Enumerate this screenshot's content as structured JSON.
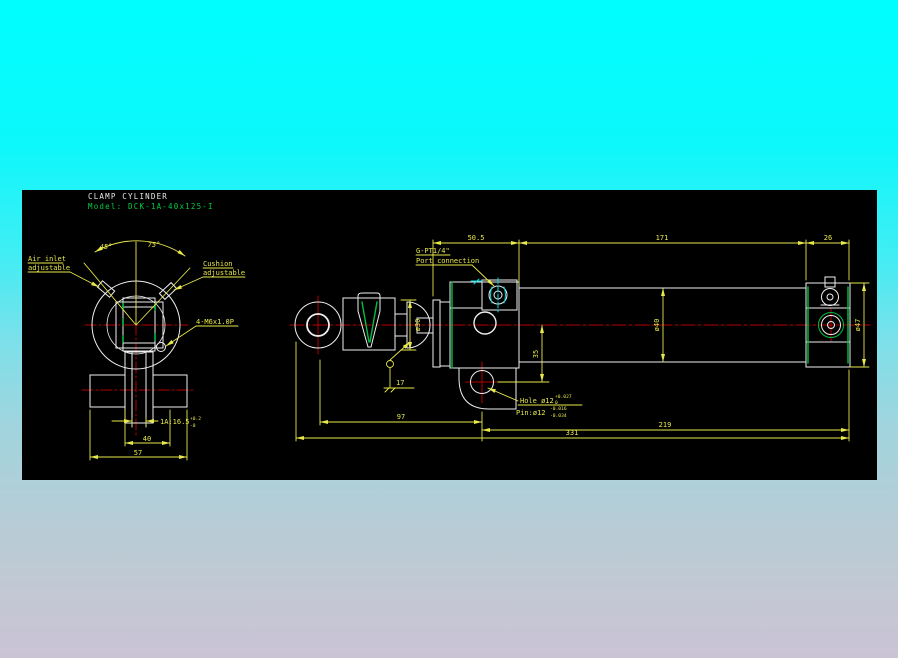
{
  "title_block": {
    "title": "CLAMP CYLINDER",
    "model": "Model: DCK-1A-40x125-I"
  },
  "colors": {
    "annotation_yellow": "#e8e84a",
    "outline_white": "#efefef",
    "centerline_red": "#b40000",
    "highlight_green": "#00c040",
    "highlight_cyan": "#00dede",
    "model_green": "#00cc44",
    "canvas_black": "#000000"
  },
  "front_view": {
    "labels": {
      "air_inlet": [
        "Air inlet",
        "adjustable"
      ],
      "cushion": [
        "Cushion",
        "adjustable"
      ],
      "thread": "4-M6x1.0P",
      "angle_left": "45°",
      "angle_right": "75°"
    },
    "dimensions": {
      "slot": {
        "text": "1A:16.5",
        "tol_upper": "+0.2",
        "tol_lower": "-0"
      },
      "width_inner": "40",
      "width_outer": "57"
    }
  },
  "side_view": {
    "labels": {
      "port_line1": "G-PT1/4\"",
      "port_line2": "Port connection",
      "hole": {
        "text": "Hole ø12",
        "tol_upper": "+0.027",
        "tol_lower": "0"
      },
      "pin": {
        "text": "Pin:ø12",
        "tol_upper": "-0.016",
        "tol_lower": "-0.034"
      }
    },
    "dimensions": {
      "head_length": "50.5",
      "tube_length": "171",
      "cap_length": "26",
      "rod_diameter": "ø30",
      "bore_diameter": "ø40",
      "cap_diameter": "ø47",
      "bracket_offset": "35",
      "rod_extension": "17",
      "eye_to_bracket": "97",
      "bracket_to_end": "219",
      "overall_length": "331"
    }
  }
}
